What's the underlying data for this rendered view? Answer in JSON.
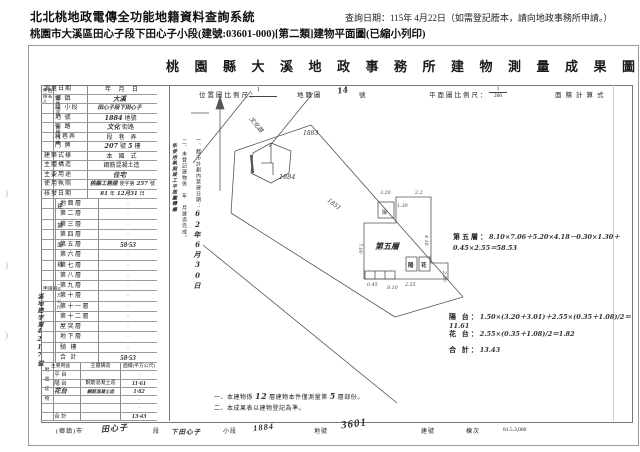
{
  "page": {
    "system_title": "北北桃地政電傳全功能地籍資料查詢系統",
    "query_date": "查詢日期：115年 4月22日（如需登記謄本，請向地政事務所申請。）",
    "subtitle": "桃園市大溪區田心子段下田心子小段(建號:03601-000)[第二類]建物平面圖(已縮小列印)",
    "margin_marks": [
      ")",
      ")",
      ")"
    ]
  },
  "doc": {
    "title": "桃園縣大溪地政事務所建物測量成果圖",
    "scalebar": {
      "loc_label": "位置圖比例尺：",
      "loc_num": "1",
      "map_label": "地籍圖",
      "map_no": "14",
      "map_unit": "號",
      "plan_label": "平面圖比例尺：",
      "plan_num": "1",
      "plan_den": "200",
      "calc_label": "面積計算式"
    },
    "applicant_label": "申請人",
    "applicant_label2": "姓名",
    "apply_doc_label": "申請書",
    "stamp": "溪地建字第4217號",
    "info_rows": [
      {
        "label": "測量日期",
        "pr": "年　 月　 日"
      },
      {
        "label": "鄉 鎮",
        "hw": "大溪",
        "cls": "ind"
      },
      {
        "label": "段 小段",
        "hw": "田心子段下田心子",
        "cls": "ind sm"
      },
      {
        "label": "地 號",
        "hw": "1884",
        "pr": "地號",
        "cls": "ind"
      },
      {
        "label": "街 路",
        "hw": "文化",
        "pr": "街路",
        "cls": "ind"
      },
      {
        "label": "段巷弄",
        "pr": "段　巷　弄",
        "cls": "ind"
      },
      {
        "label": "門 牌",
        "hw": "207",
        "pr": "號",
        "hw2": "5",
        "pr2": "樓",
        "cls": "ind"
      },
      {
        "label": "建築式樣",
        "pr": "本　國　式"
      },
      {
        "label": "主體構造",
        "pr": "鋼筋混凝土造"
      },
      {
        "label": "主要用途",
        "hw": "住宅"
      },
      {
        "label": "使用執照",
        "hw": "桃縣工務建",
        "pr": "使字第",
        "hw2": "257",
        "pr2": "號",
        "cls": "sm"
      },
      {
        "label": "核發日期",
        "hw": "81",
        "pr": "年",
        "hw2": "12月31",
        "pr2": "日",
        "cls": "sm"
      }
    ],
    "site_label": "基地坐落",
    "door_label": "建物門牌",
    "floor_section_label": "建築面積",
    "floor_section_sub": "（平方公尺）",
    "floors": [
      {
        "label": "地面層",
        "value": "·"
      },
      {
        "label": "第二層",
        "value": "·"
      },
      {
        "label": "第三層",
        "value": "·"
      },
      {
        "label": "第四層",
        "value": "·"
      },
      {
        "label": "第五層",
        "value": "58·53",
        "cls": "hwv"
      },
      {
        "label": "第六層",
        "value": "·"
      },
      {
        "label": "第七層",
        "value": "·"
      },
      {
        "label": "第八層",
        "value": "·"
      },
      {
        "label": "第九層",
        "value": "·"
      },
      {
        "label": "第十層",
        "value": "·"
      },
      {
        "label": "第十一層",
        "value": "·"
      },
      {
        "label": "第十二層",
        "value": "·"
      },
      {
        "label": "屋突層",
        "value": "·"
      },
      {
        "label": "地下層",
        "value": "·"
      },
      {
        "label": "騎 樓",
        "value": "·"
      },
      {
        "label": "合 計",
        "value": "58·53",
        "cls": "hwv"
      }
    ],
    "attached_label": "附屬建物",
    "attached_header": {
      "c1": "主要用途",
      "c2": "主體構造",
      "c3": "面積(平方公尺)"
    },
    "attached_rows": [
      {
        "c1": "平 台",
        "c3": "·"
      },
      {
        "c1": "陽 台",
        "c2": "鋼筋混凝土造",
        "c3": "11·61",
        "cls": "hwv"
      },
      {
        "c1": "花台",
        "c2": "鋼筋混凝土造",
        "c3": "1·82",
        "cls": "hwall"
      },
      {
        "c3": "·"
      },
      {
        "c3": "·"
      },
      {
        "c1": "合 計",
        "c3": "13·43",
        "cls": "hwv"
      }
    ],
    "vnotes": {
      "transcribe": "依使用執照竣工平面圖轉繪",
      "n1": "一、都市計劃內禁建日期：",
      "n1_date": "62年6月30日",
      "n2": "二、未登記建物係　年　月建造完成。"
    },
    "map": {
      "road": "文化路",
      "p1": "1883",
      "p2": "1884",
      "p3": "1851"
    },
    "plan": {
      "label": "第五層",
      "box_top": "陽",
      "box_b1": "陽",
      "box_b2": "花",
      "d_top": "3.20",
      "d_t2": "1.30",
      "d_t3": "2.2",
      "d_right": "4.18",
      "d_r2": "2.30",
      "d_left": "7.00",
      "d_bottom": "8.10",
      "d_b2": "2.55",
      "d_b3": "0.45"
    },
    "calc": {
      "f5_label": "第五層：",
      "f5": "8.10×7.06＋5.20×4.18－0.30×1.30＋0.45×2.55＝58.53",
      "bal_label": "陽 台：",
      "bal": "1.50×(3.20＋3.01)＋2.55×(0.35＋1.08)/2＝11.61",
      "flw_label": "花 台：",
      "flw": "2.55×(0.35＋1.08)/2＝1.82",
      "tot_label": "合 計：",
      "tot": "13.43"
    },
    "notes": {
      "n1a": "一、本建物係",
      "n1_hw1": "12",
      "n1b": "層建物本件僅測量第",
      "n1_hw2": "5",
      "n1c": "層部份。",
      "n2": "二、本成果表以建物登記為準。"
    },
    "footer": {
      "town": "(鄉鎮)市",
      "sec_v": "田心子",
      "sec": "段",
      "sub_v": "下田心子",
      "sub": "小段",
      "parcel_v": "1884",
      "parcel": "地號",
      "bldg_v": "3601",
      "bldg": "建號",
      "unit": "棟次",
      "code": "81.5.3,000"
    }
  }
}
